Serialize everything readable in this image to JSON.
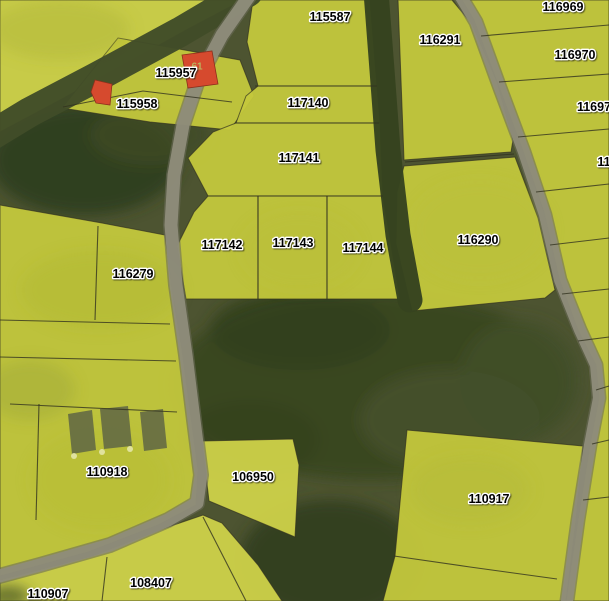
{
  "map": {
    "width": 609,
    "height": 601,
    "colors": {
      "forest_base": "#4d5431",
      "parcel_yellow": "#c5c93d",
      "parcel_yellow_light": "#cfd249",
      "boundary": "#32321f",
      "road_grey": "#8f8d7b",
      "road_casing": "#6b6b58",
      "tree_band_dark": "#3a4722",
      "tree_band_brown": "#454f29",
      "building_red": "#d64a2e",
      "building_red_edge": "#8e2f1c",
      "structure_grey": "#646a44",
      "structure_dot": "#e4e6a8",
      "label_text": "#000000",
      "label_halo": "#ffffff",
      "building_number_color": "#b9bd62"
    },
    "label_font_size": 12.5,
    "texture_under": [
      {
        "cx": 370,
        "cy": 385,
        "rx": 200,
        "ry": 95,
        "fill": "#39451f",
        "op": 0.9
      },
      {
        "cx": 300,
        "cy": 330,
        "rx": 90,
        "ry": 40,
        "fill": "#31401c",
        "op": 0.8
      },
      {
        "cx": 450,
        "cy": 420,
        "rx": 90,
        "ry": 50,
        "fill": "#46512c",
        "op": 0.9
      },
      {
        "cx": 250,
        "cy": 440,
        "rx": 70,
        "ry": 40,
        "fill": "#36431f",
        "op": 0.85
      },
      {
        "cx": 85,
        "cy": 160,
        "rx": 95,
        "ry": 55,
        "fill": "#2f3d1e",
        "op": 0.9
      },
      {
        "cx": 150,
        "cy": 135,
        "rx": 60,
        "ry": 30,
        "fill": "#3d4a24",
        "op": 0.8
      },
      {
        "cx": 330,
        "cy": 560,
        "rx": 90,
        "ry": 60,
        "fill": "#323f1e",
        "op": 0.9
      },
      {
        "cx": 520,
        "cy": 380,
        "rx": 60,
        "ry": 60,
        "fill": "#42502a",
        "op": 0.85
      }
    ],
    "texture_over": [
      {
        "cx": 60,
        "cy": 30,
        "rx": 70,
        "ry": 30,
        "fill": "#a8b037",
        "op": 0.35
      },
      {
        "cx": 100,
        "cy": 290,
        "rx": 80,
        "ry": 40,
        "fill": "#aab233",
        "op": 0.3
      },
      {
        "cx": 300,
        "cy": 250,
        "rx": 60,
        "ry": 40,
        "fill": "#b4bb35",
        "op": 0.22
      },
      {
        "cx": 480,
        "cy": 230,
        "rx": 70,
        "ry": 50,
        "fill": "#b8bf37",
        "op": 0.28
      },
      {
        "cx": 100,
        "cy": 480,
        "rx": 70,
        "ry": 50,
        "fill": "#b2b933",
        "op": 0.3
      },
      {
        "cx": 30,
        "cy": 390,
        "rx": 45,
        "ry": 30,
        "fill": "#8f9a36",
        "op": 0.3
      },
      {
        "cx": 8,
        "cy": 596,
        "rx": 22,
        "ry": 10,
        "fill": "#3c4824",
        "op": 0.7
      },
      {
        "cx": 470,
        "cy": 490,
        "rx": 60,
        "ry": 35,
        "fill": "#aeb535",
        "op": 0.3
      }
    ],
    "parcels": [
      {
        "name": "topleft-field",
        "fill": "light",
        "points": [
          [
            0,
            0
          ],
          [
            243,
            0
          ],
          [
            190,
            28
          ],
          [
            60,
            100
          ],
          [
            0,
            132
          ]
        ]
      },
      {
        "name": "parcel-115957",
        "fill": "normal",
        "points": [
          [
            118,
            38
          ],
          [
            240,
            60
          ],
          [
            254,
            96
          ],
          [
            230,
            130
          ],
          [
            150,
            122
          ],
          [
            62,
            108
          ]
        ]
      },
      {
        "name": "parcel-115587",
        "fill": "normal",
        "points": [
          [
            253,
            0
          ],
          [
            370,
            0
          ],
          [
            377,
            86
          ],
          [
            258,
            86
          ],
          [
            247,
            42
          ]
        ]
      },
      {
        "name": "parcel-117140",
        "fill": "normal",
        "points": [
          [
            258,
            86
          ],
          [
            377,
            86
          ],
          [
            380,
            123
          ],
          [
            236,
            123
          ],
          [
            246,
            96
          ]
        ]
      },
      {
        "name": "parcel-117141",
        "fill": "normal",
        "points": [
          [
            236,
            123
          ],
          [
            380,
            123
          ],
          [
            383,
            196
          ],
          [
            208,
            196
          ],
          [
            188,
            158
          ],
          [
            213,
            132
          ]
        ]
      },
      {
        "name": "parcel-117142",
        "fill": "normal",
        "points": [
          [
            208,
            196
          ],
          [
            258,
            196
          ],
          [
            258,
            299
          ],
          [
            186,
            299
          ],
          [
            177,
            246
          ],
          [
            194,
            212
          ]
        ]
      },
      {
        "name": "parcel-117143",
        "fill": "normal",
        "points": [
          [
            258,
            196
          ],
          [
            327,
            196
          ],
          [
            327,
            299
          ],
          [
            258,
            299
          ]
        ]
      },
      {
        "name": "parcel-117144",
        "fill": "normal",
        "points": [
          [
            327,
            196
          ],
          [
            383,
            196
          ],
          [
            400,
            299
          ],
          [
            327,
            299
          ]
        ]
      },
      {
        "name": "parcel-116291",
        "fill": "normal",
        "points": [
          [
            398,
            0
          ],
          [
            452,
            0
          ],
          [
            472,
            24
          ],
          [
            497,
            82
          ],
          [
            513,
            140
          ],
          [
            511,
            152
          ],
          [
            404,
            160
          ]
        ]
      },
      {
        "name": "parcel-116290",
        "fill": "normal",
        "points": [
          [
            404,
            166
          ],
          [
            515,
            157
          ],
          [
            538,
            218
          ],
          [
            555,
            290
          ],
          [
            545,
            298
          ],
          [
            412,
            311
          ],
          [
            396,
            244
          ],
          [
            397,
            192
          ]
        ]
      },
      {
        "name": "east-strip-parcels",
        "fill": "normal",
        "points": [
          [
            462,
            0
          ],
          [
            609,
            0
          ],
          [
            609,
            601
          ],
          [
            566,
            601
          ],
          [
            578,
            520
          ],
          [
            590,
            445
          ],
          [
            599,
            398
          ],
          [
            596,
            365
          ],
          [
            578,
            330
          ],
          [
            559,
            278
          ],
          [
            544,
            212
          ],
          [
            522,
            148
          ],
          [
            498,
            84
          ],
          [
            474,
            20
          ]
        ]
      },
      {
        "name": "parcel-116279-block",
        "fill": "normal",
        "points": [
          [
            0,
            205
          ],
          [
            102,
            223
          ],
          [
            165,
            235
          ],
          [
            172,
            290
          ],
          [
            182,
            350
          ],
          [
            190,
            410
          ],
          [
            198,
            470
          ],
          [
            196,
            505
          ],
          [
            158,
            525
          ],
          [
            88,
            552
          ],
          [
            0,
            576
          ]
        ]
      },
      {
        "name": "bottomleft-block",
        "fill": "light",
        "points": [
          [
            0,
            580
          ],
          [
            92,
            556
          ],
          [
            165,
            528
          ],
          [
            203,
            515
          ],
          [
            222,
            523
          ],
          [
            258,
            565
          ],
          [
            282,
            601
          ],
          [
            0,
            601
          ]
        ]
      },
      {
        "name": "parcel-106950",
        "fill": "light",
        "points": [
          [
            202,
            441
          ],
          [
            293,
            439
          ],
          [
            299,
            465
          ],
          [
            295,
            537
          ],
          [
            209,
            501
          ]
        ]
      },
      {
        "name": "parcel-110917",
        "fill": "normal",
        "points": [
          [
            407,
            430
          ],
          [
            583,
            446
          ],
          [
            576,
            520
          ],
          [
            566,
            601
          ],
          [
            383,
            601
          ],
          [
            395,
            556
          ],
          [
            401,
            492
          ]
        ]
      }
    ],
    "tree_bands": [
      {
        "name": "topleft-tree-band",
        "width": 30,
        "color": "#414c28",
        "points": [
          [
            248,
            -8
          ],
          [
            180,
            32
          ],
          [
            95,
            78
          ],
          [
            30,
            112
          ],
          [
            -8,
            135
          ]
        ]
      },
      {
        "name": "center-tree-strip",
        "width": 25,
        "color": "#36431f",
        "points": [
          [
            376,
            -8
          ],
          [
            382,
            70
          ],
          [
            388,
            150
          ],
          [
            398,
            235
          ],
          [
            410,
            300
          ]
        ]
      }
    ],
    "roads": [
      {
        "name": "west-road",
        "width": 13,
        "points": [
          [
            252,
            -8
          ],
          [
            222,
            35
          ],
          [
            198,
            80
          ],
          [
            183,
            125
          ],
          [
            174,
            175
          ],
          [
            171,
            225
          ],
          [
            176,
            285
          ],
          [
            186,
            355
          ],
          [
            194,
            420
          ],
          [
            201,
            475
          ],
          [
            197,
            503
          ],
          [
            168,
            520
          ],
          [
            110,
            545
          ],
          [
            40,
            565
          ],
          [
            -8,
            578
          ]
        ]
      },
      {
        "name": "east-road",
        "width": 12,
        "points": [
          [
            458,
            -8
          ],
          [
            476,
            22
          ],
          [
            500,
            88
          ],
          [
            524,
            152
          ],
          [
            545,
            215
          ],
          [
            560,
            280
          ],
          [
            580,
            330
          ],
          [
            596,
            365
          ],
          [
            599,
            398
          ],
          [
            590,
            445
          ],
          [
            578,
            520
          ],
          [
            566,
            608
          ]
        ]
      }
    ],
    "boundary_lines": [
      [
        [
          255,
          86
        ],
        [
          377,
          86
        ]
      ],
      [
        [
          236,
          123
        ],
        [
          379,
          123
        ]
      ],
      [
        [
          208,
          196
        ],
        [
          383,
          196
        ]
      ],
      [
        [
          258,
          196
        ],
        [
          258,
          299
        ]
      ],
      [
        [
          327,
          196
        ],
        [
          327,
          299
        ]
      ],
      [
        [
          405,
          162
        ],
        [
          514,
          154
        ]
      ],
      [
        [
          481,
          36
        ],
        [
          609,
          25
        ]
      ],
      [
        [
          499,
          82
        ],
        [
          609,
          74
        ]
      ],
      [
        [
          518,
          137
        ],
        [
          609,
          129
        ]
      ],
      [
        [
          536,
          192
        ],
        [
          609,
          184
        ]
      ],
      [
        [
          550,
          245
        ],
        [
          609,
          238
        ]
      ],
      [
        [
          562,
          294
        ],
        [
          609,
          289
        ]
      ],
      [
        [
          578,
          341
        ],
        [
          609,
          337
        ]
      ],
      [
        [
          596,
          390
        ],
        [
          609,
          386
        ]
      ],
      [
        [
          592,
          444
        ],
        [
          609,
          440
        ]
      ],
      [
        [
          583,
          500
        ],
        [
          609,
          497
        ]
      ],
      [
        [
          394,
          556
        ],
        [
          470,
          567
        ],
        [
          557,
          579
        ]
      ],
      [
        [
          63,
          107
        ],
        [
          143,
          91
        ],
        [
          232,
          102
        ]
      ],
      [
        [
          98,
          226
        ],
        [
          95,
          320
        ]
      ],
      [
        [
          0,
          320
        ],
        [
          170,
          324
        ]
      ],
      [
        [
          0,
          357
        ],
        [
          176,
          361
        ]
      ],
      [
        [
          10,
          404
        ],
        [
          177,
          412
        ]
      ],
      [
        [
          39,
          404
        ],
        [
          36,
          520
        ]
      ],
      [
        [
          107,
          557
        ],
        [
          102,
          601
        ]
      ],
      [
        [
          203,
          517
        ],
        [
          246,
          601
        ]
      ]
    ],
    "structures": [
      {
        "points": [
          [
            68,
            414
          ],
          [
            92,
            410
          ],
          [
            96,
            450
          ],
          [
            72,
            454
          ]
        ]
      },
      {
        "points": [
          [
            100,
            409
          ],
          [
            128,
            406
          ],
          [
            132,
            446
          ],
          [
            104,
            449
          ]
        ]
      },
      {
        "points": [
          [
            140,
            412
          ],
          [
            163,
            409
          ],
          [
            167,
            448
          ],
          [
            144,
            451
          ]
        ]
      }
    ],
    "structure_dots": [
      {
        "cx": 74,
        "cy": 456,
        "r": 3
      },
      {
        "cx": 102,
        "cy": 452,
        "r": 3
      },
      {
        "cx": 130,
        "cy": 449,
        "r": 3
      }
    ],
    "buildings": [
      {
        "name": "building-115957-main",
        "points": [
          [
            182,
            55
          ],
          [
            212,
            51
          ],
          [
            218,
            84
          ],
          [
            188,
            88
          ]
        ]
      },
      {
        "name": "building-115958-small",
        "points": [
          [
            95,
            80
          ],
          [
            112,
            84
          ],
          [
            110,
            105
          ],
          [
            96,
            103
          ],
          [
            91,
            92
          ]
        ]
      }
    ],
    "building_number": {
      "text": "61",
      "x": 197,
      "y": 67
    },
    "parcel_labels": [
      {
        "text": "115587",
        "x": 330,
        "y": 17
      },
      {
        "text": "116291",
        "x": 440,
        "y": 40
      },
      {
        "text": "116969",
        "x": 563,
        "y": 7
      },
      {
        "text": "116970",
        "x": 575,
        "y": 55
      },
      {
        "text": "11697",
        "x": 594,
        "y": 107
      },
      {
        "text": "11",
        "x": 604,
        "y": 162
      },
      {
        "text": "115957",
        "x": 176,
        "y": 73
      },
      {
        "text": "115958",
        "x": 137,
        "y": 104
      },
      {
        "text": "117140",
        "x": 308,
        "y": 103
      },
      {
        "text": "117141",
        "x": 299,
        "y": 158
      },
      {
        "text": "117142",
        "x": 222,
        "y": 245
      },
      {
        "text": "117143",
        "x": 293,
        "y": 243
      },
      {
        "text": "117144",
        "x": 363,
        "y": 248
      },
      {
        "text": "116290",
        "x": 478,
        "y": 240
      },
      {
        "text": "116279",
        "x": 133,
        "y": 274
      },
      {
        "text": "110918",
        "x": 107,
        "y": 472
      },
      {
        "text": "106950",
        "x": 253,
        "y": 477
      },
      {
        "text": "110917",
        "x": 489,
        "y": 499
      },
      {
        "text": "108407",
        "x": 151,
        "y": 583
      },
      {
        "text": "110907",
        "x": 48,
        "y": 594
      }
    ]
  }
}
